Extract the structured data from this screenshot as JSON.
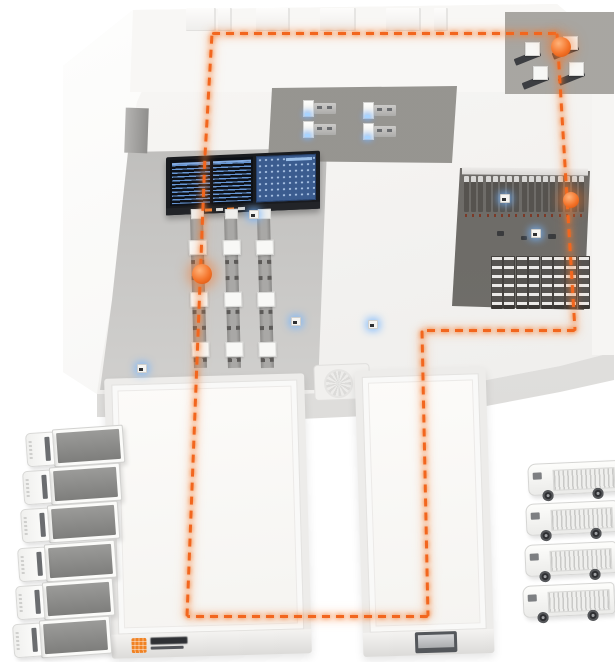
{
  "scene": {
    "title": "smart-warehouse-isometric-illustration",
    "colors": {
      "route": "#f2661e",
      "route_glow": "rgba(246,125,45,0.25)",
      "marker": "#f4742a",
      "sensor_glow": "#73b4ff",
      "screen_blue": "#6c9ee0",
      "screen_panel": "#3b5c8f",
      "logo_orange": "#f08223",
      "floor": "#f1f0ee",
      "recess": "#cfcecc"
    },
    "logo": {
      "mark": "orange-grid-square",
      "wordmark_lines": 2,
      "legible": false
    },
    "route": {
      "style": "dashed",
      "segments": [
        [
          212,
          33,
          557,
          33
        ],
        [
          557,
          33,
          575,
          330
        ],
        [
          575,
          330,
          422,
          330
        ],
        [
          422,
          330,
          428,
          616
        ],
        [
          428,
          616,
          187,
          616
        ],
        [
          187,
          616,
          205,
          155
        ],
        [
          205,
          155,
          212,
          33
        ]
      ]
    },
    "markers": [
      {
        "x": 561,
        "y": 47,
        "d": 20
      },
      {
        "x": 571,
        "y": 200,
        "d": 16
      },
      {
        "x": 202,
        "y": 274,
        "d": 20
      }
    ],
    "sensors": [
      {
        "x": 137,
        "y": 364
      },
      {
        "x": 249,
        "y": 210
      },
      {
        "x": 291,
        "y": 317
      },
      {
        "x": 368,
        "y": 320
      },
      {
        "x": 500,
        "y": 194
      },
      {
        "x": 531,
        "y": 229
      }
    ],
    "roof_blocks": [
      {
        "x": 186,
        "w": 28
      },
      {
        "x": 218,
        "w": 12
      },
      {
        "x": 256,
        "w": 32
      },
      {
        "x": 320,
        "w": 34
      },
      {
        "x": 386,
        "w": 33
      },
      {
        "x": 434,
        "w": 12
      }
    ],
    "dashboard": {
      "x": 166,
      "y": 154,
      "w": 154,
      "h": 58,
      "left_columns": 2,
      "base_chips": [
        "#d8d8d6",
        "#f08030",
        "#d8d8d6",
        "#f08030",
        "#d8d8d6"
      ]
    },
    "conveyors": {
      "lines": [
        {
          "x": 190,
          "y": 216
        },
        {
          "x": 224,
          "y": 216
        },
        {
          "x": 257,
          "y": 216
        }
      ],
      "height": 152,
      "box_offsets": [
        24,
        76,
        126
      ],
      "foot_offsets": [
        44,
        60,
        94,
        110,
        142
      ]
    },
    "racks": {
      "back_row": {
        "count": 17,
        "x_start": 464,
        "x_step": 7.2
      },
      "front_row": {
        "count": 8,
        "x_start": 491,
        "x_step": 12.4
      },
      "crates": [
        {
          "x": 497,
          "y": 231,
          "w": 7,
          "h": 5
        },
        {
          "x": 521,
          "y": 236,
          "w": 6,
          "h": 4
        },
        {
          "x": 548,
          "y": 234,
          "w": 8,
          "h": 5
        }
      ]
    },
    "machines_topright": [
      {
        "x": 514,
        "y": 42
      },
      {
        "x": 552,
        "y": 36
      },
      {
        "x": 522,
        "y": 66
      },
      {
        "x": 558,
        "y": 62
      }
    ],
    "workstations": [
      {
        "x": 303,
        "y": 100
      },
      {
        "x": 303,
        "y": 121
      },
      {
        "x": 363,
        "y": 102
      },
      {
        "x": 363,
        "y": 123
      }
    ],
    "wings": {
      "left": {
        "x": 108,
        "y": 376,
        "w": 200,
        "h": 280,
        "rot": -1.6,
        "has_logo": true
      },
      "right": {
        "x": 359,
        "y": 369,
        "w": 131,
        "h": 286,
        "rot": -1.8,
        "has_door": true
      }
    },
    "trucks_left": {
      "type": "box-truck",
      "count": 6,
      "positions": [
        [
          26,
          428
        ],
        [
          23,
          466
        ],
        [
          21,
          504
        ],
        [
          18,
          543
        ],
        [
          16,
          581
        ],
        [
          13,
          619
        ]
      ]
    },
    "vans_right": {
      "type": "delivery-van",
      "count": 4,
      "positions": [
        [
          528,
          462
        ],
        [
          526,
          502
        ],
        [
          525,
          543
        ],
        [
          523,
          584
        ]
      ]
    }
  }
}
